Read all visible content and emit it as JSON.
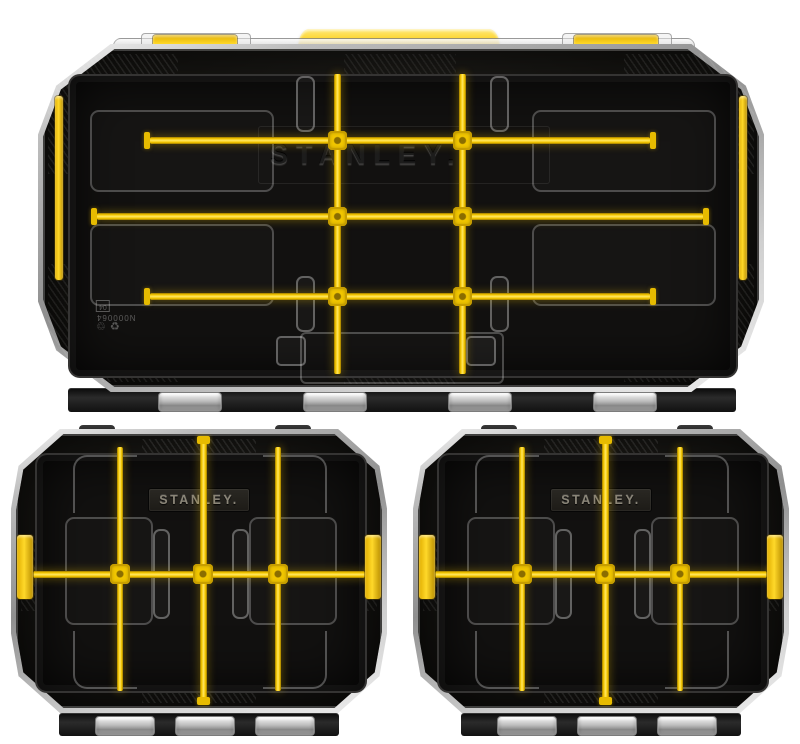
{
  "page": {
    "background": "#ffffff"
  },
  "large_organizer": {
    "brand_text": "STANLEY.",
    "mold_code": "N000064",
    "mold_box_label": "04"
  },
  "small_organizers": [
    {
      "brand_text": "STANLEY."
    },
    {
      "brand_text": "STANLEY."
    }
  ],
  "icons": {
    "recycle_universal": "♻",
    "recycle_generic": "♲"
  },
  "colors": {
    "stanley_yellow": "#f6c800",
    "yellow_highlight": "#ffe763",
    "case_black": "#171613",
    "clear_rim": "#cfcfcf",
    "badge_text": "#8a8578",
    "background": "#ffffff"
  }
}
